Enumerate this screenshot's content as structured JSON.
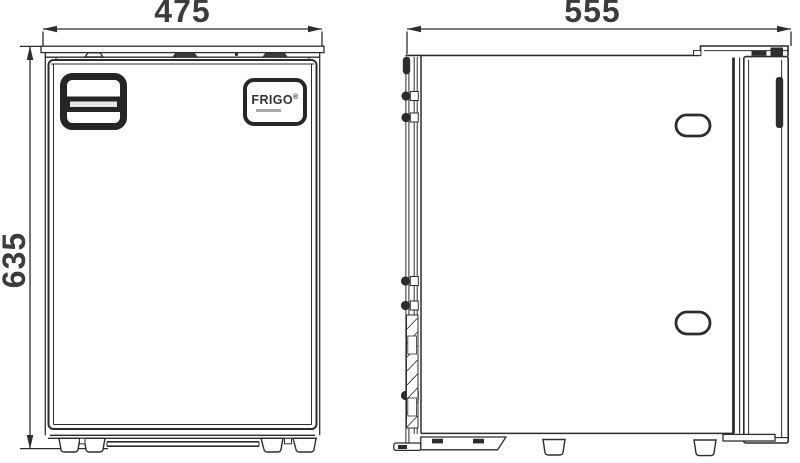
{
  "drawing": {
    "dimensions": {
      "front_width": "475",
      "front_height": "635",
      "side_depth": "555"
    },
    "logo": {
      "text": "FRIGO",
      "mark": "®"
    },
    "colors": {
      "line": "#2d2d2d",
      "dim_text": "#3c3c3c",
      "background": "#ffffff"
    }
  }
}
